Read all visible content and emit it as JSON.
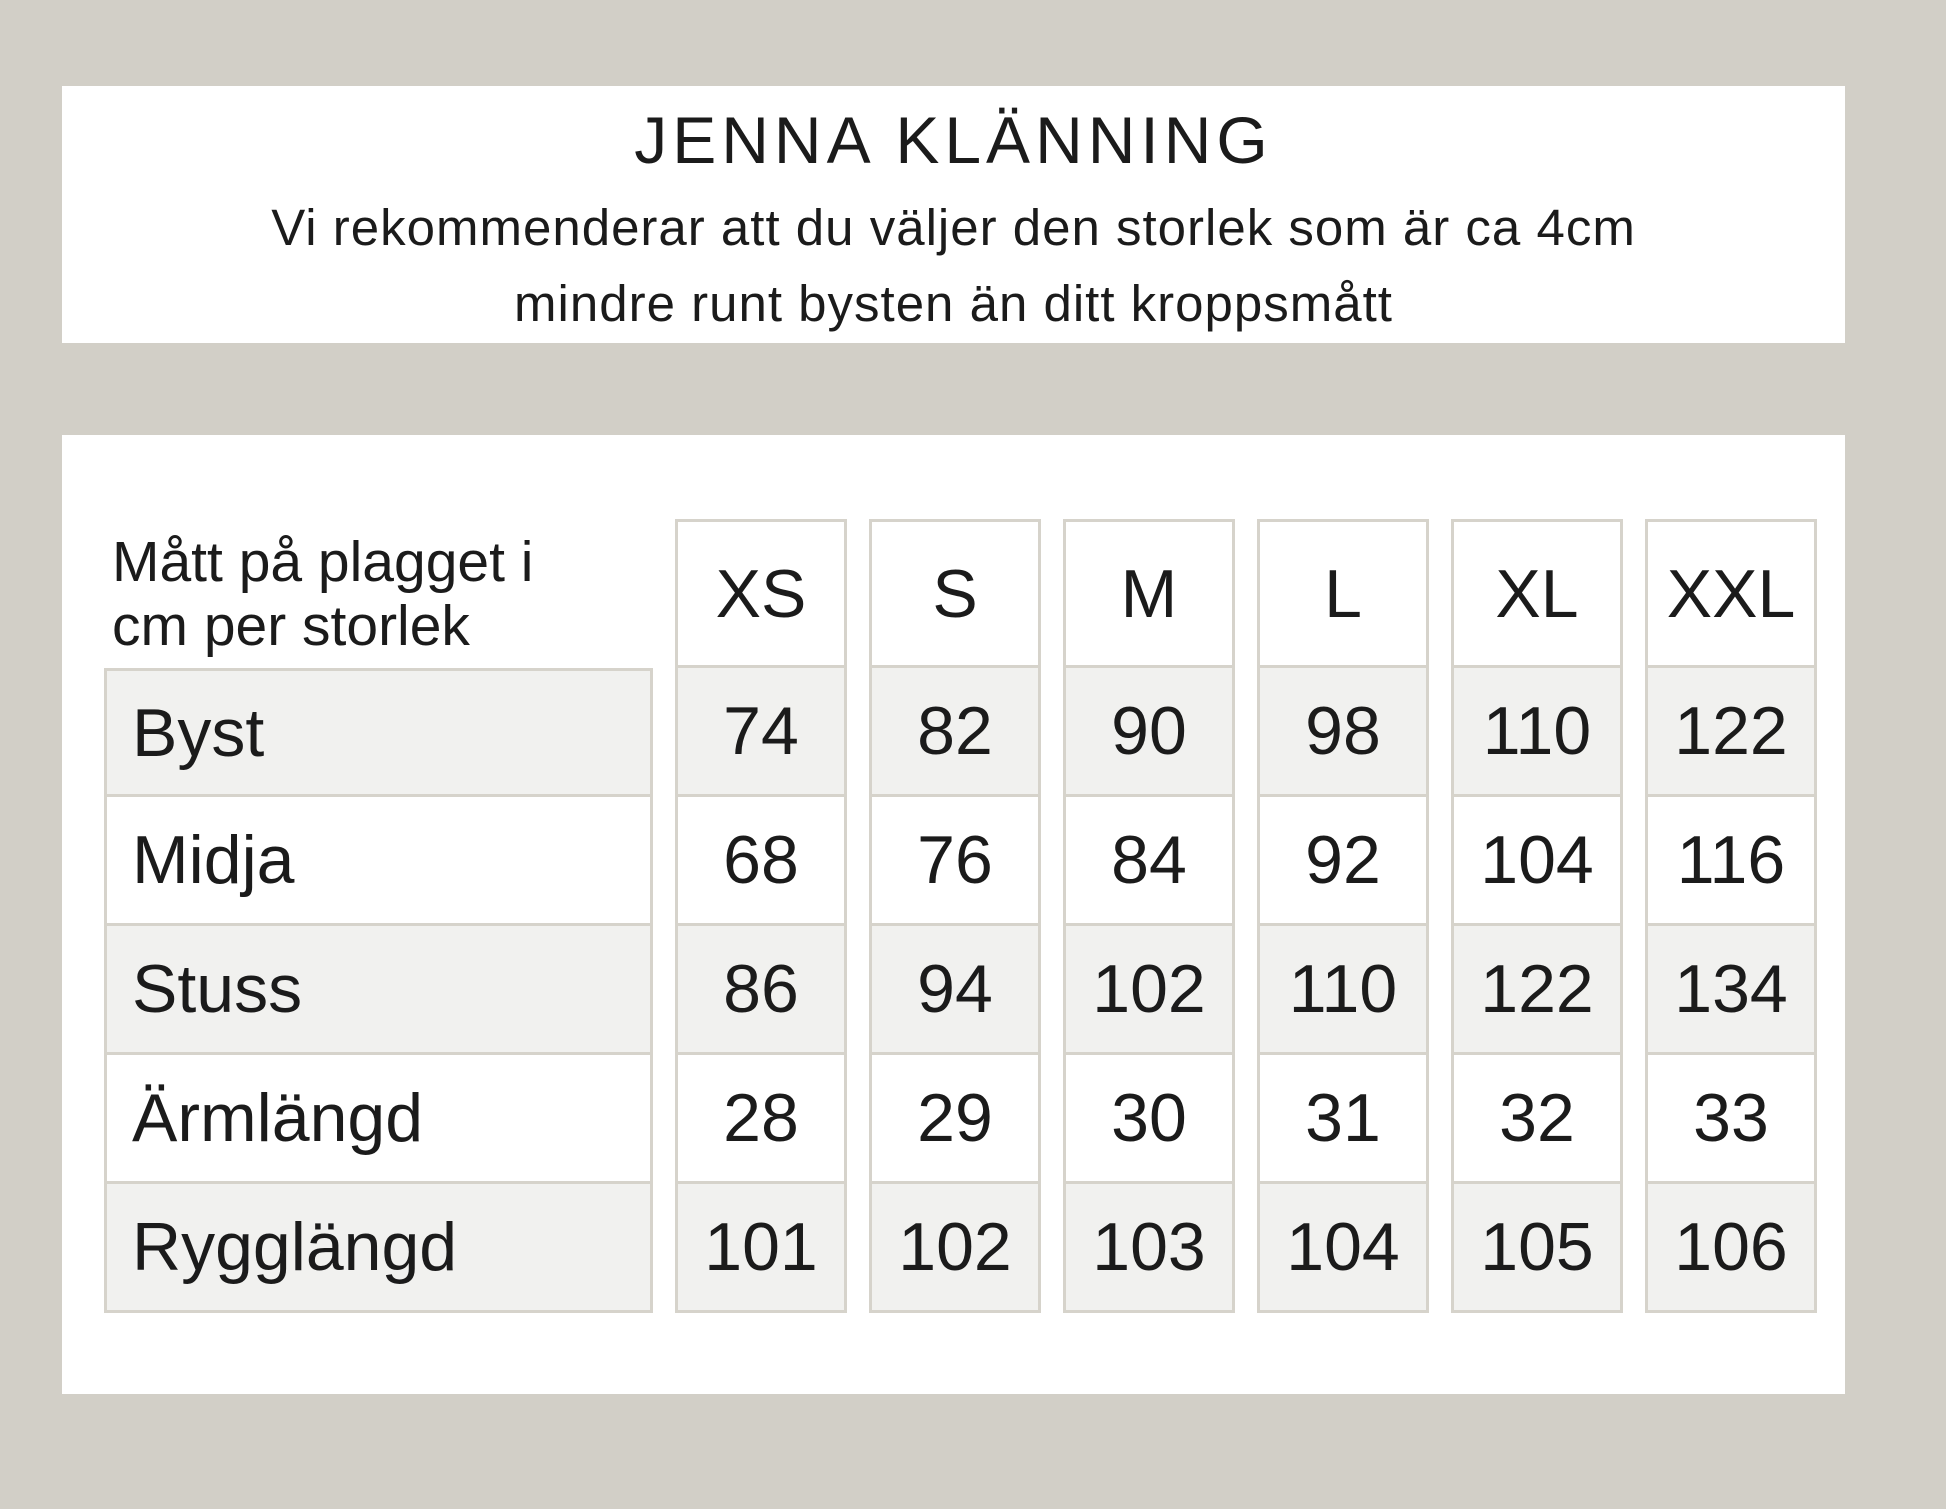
{
  "colors": {
    "page_background": "#d2cfc7",
    "panel_background": "#ffffff",
    "cell_border": "#d6d3cb",
    "row_alternate_background": "#f1f1ef",
    "text": "#1b1b1b"
  },
  "header": {
    "title": "JENNA KLÄNNING",
    "subtitle_lines": [
      "Vi rekommenderar att du väljer den storlek som är ca 4cm",
      "mindre runt bysten än ditt kroppsmått"
    ]
  },
  "size_table": {
    "caption_lines": [
      "Mått på plagget i",
      "cm per storlek"
    ],
    "columns": [
      "XS",
      "S",
      "M",
      "L",
      "XL",
      "XXL"
    ],
    "rows": [
      {
        "label": "Byst",
        "values": [
          "74",
          "82",
          "90",
          "98",
          "110",
          "122"
        ]
      },
      {
        "label": "Midja",
        "values": [
          "68",
          "76",
          "84",
          "92",
          "104",
          "116"
        ]
      },
      {
        "label": "Stuss",
        "values": [
          "86",
          "94",
          "102",
          "110",
          "122",
          "134"
        ]
      },
      {
        "label": "Ärmlängd",
        "values": [
          "28",
          "29",
          "30",
          "31",
          "32",
          "33"
        ]
      },
      {
        "label": "Rygglängd",
        "values": [
          "101",
          "102",
          "103",
          "104",
          "105",
          "106"
        ]
      }
    ]
  },
  "chart_data": {
    "type": "table",
    "title": "JENNA KLÄNNING",
    "subtitle": "Vi rekommenderar att du väljer den storlek som är ca 4cm mindre runt bysten än ditt kroppsmått",
    "caption": "Mått på plagget i cm per storlek",
    "columns": [
      "XS",
      "S",
      "M",
      "L",
      "XL",
      "XXL"
    ],
    "rows": [
      {
        "label": "Byst",
        "values": [
          74,
          82,
          90,
          98,
          110,
          122
        ]
      },
      {
        "label": "Midja",
        "values": [
          68,
          76,
          84,
          92,
          104,
          116
        ]
      },
      {
        "label": "Stuss",
        "values": [
          86,
          94,
          102,
          110,
          122,
          134
        ]
      },
      {
        "label": "Ärmlängd",
        "values": [
          28,
          29,
          30,
          31,
          32,
          33
        ]
      },
      {
        "label": "Rygglängd",
        "values": [
          101,
          102,
          103,
          104,
          105,
          106
        ]
      }
    ]
  }
}
